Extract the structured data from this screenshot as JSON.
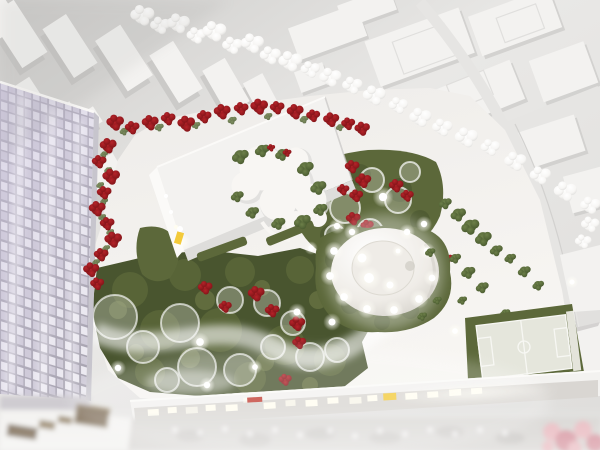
{
  "scene": {
    "kind": "photograph-of-architectural-scale-model"
  },
  "palette": {
    "bg_shade": "#cdccca",
    "bg_light": "#e9e8e6",
    "bg_low": "#dfdedc",
    "model_white": "#f3f2f0",
    "model_bright": "#fbfaf8",
    "model_shadow": "#c6c5c3",
    "model_mid": "#dedddb",
    "road": "#e6e5e3",
    "curb": "#d2d1cf",
    "site_ground": "#efedea",
    "site_bright": "#f8f6f3",
    "tower_cell_a": "#eceaf1",
    "tower_cell_b": "#cfcbd8",
    "tower_gap": "#a9a5b2",
    "tower_streak": "#fdfcff",
    "tower_edge": "#c7c5cd",
    "lavender": "#cfc8e0",
    "garden_dark": "#49552f",
    "garden_mid": "#5c683a",
    "garden_light": "#75804b",
    "tree_green": "#6d8049",
    "tree_green_dark": "#44552c",
    "red_flower": "#b52329",
    "red_flower_dark": "#7e1317",
    "white_tree": "#f7f6f4",
    "white_tree_shadow": "#d5d4d2",
    "glow": "#fffef7",
    "warm_glow": "#fdf3d8",
    "yellow_door": "#f3ca3a",
    "sign_red": "#c23d33",
    "facade_dim": "#d9d6d2",
    "window_glow": "#fffdf0",
    "brown_a": "#7c6b54",
    "brown_b": "#9b8b71",
    "pink": "#e9bac0",
    "pink_deep": "#d795a0",
    "court": "#e5e6dc",
    "court_line": "#f7f7f3",
    "dome_mid": "#efece7",
    "dome_shadow": "#d2cfc8",
    "street_gray": "#d8d6d3",
    "blob_gray": "#bfbdba"
  }
}
